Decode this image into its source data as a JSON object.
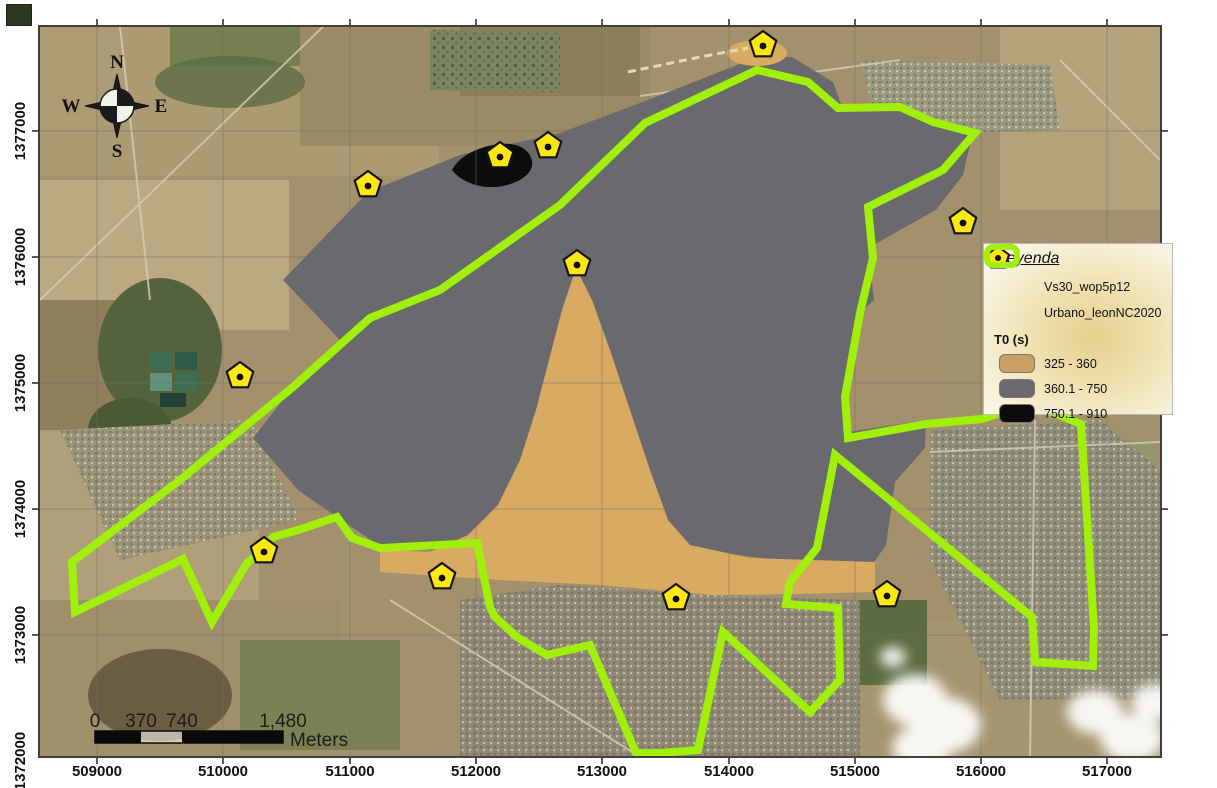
{
  "axes": {
    "x_ticks": [
      "509000",
      "510000",
      "511000",
      "512000",
      "513000",
      "514000",
      "515000",
      "516000",
      "517000"
    ],
    "y_ticks": [
      "1377000",
      "1376000",
      "1375000",
      "1374000",
      "1373000",
      "1372000"
    ]
  },
  "compass": {
    "n": "N",
    "s": "S",
    "e": "E",
    "w": "W"
  },
  "scalebar": {
    "labels": [
      "0",
      "370",
      "740",
      "1,480"
    ],
    "unit": "Meters"
  },
  "legend": {
    "title": "Leyenda",
    "items": [
      {
        "symbol": "pentagon-marker",
        "label": "Vs30_wop5p12"
      },
      {
        "symbol": "green-outline",
        "label": "Urbano_leonNC2020"
      }
    ],
    "section_title": "T0 (s)",
    "classes": [
      {
        "range": "325 - 360",
        "color": "#c9a263"
      },
      {
        "range": "360.1 - 750",
        "color": "#6a696d"
      },
      {
        "range": "750.1 - 910",
        "color": "#0c0c0c"
      }
    ]
  },
  "layers": {
    "markers": {
      "name": "Vs30_wop5p12",
      "fill": "#ffe70f",
      "points": [
        [
          763,
          45
        ],
        [
          500,
          156
        ],
        [
          548,
          146
        ],
        [
          368,
          185
        ],
        [
          577,
          264
        ],
        [
          963,
          222
        ],
        [
          240,
          376
        ],
        [
          264,
          551
        ],
        [
          442,
          577
        ],
        [
          676,
          598
        ],
        [
          887,
          595
        ]
      ]
    },
    "urban_boundary": {
      "name": "Urbano_leonNC2020",
      "color": "#a2ef0a",
      "points": [
        [
          645,
          123
        ],
        [
          757,
          70
        ],
        [
          808,
          82
        ],
        [
          838,
          108
        ],
        [
          900,
          107
        ],
        [
          933,
          122
        ],
        [
          975,
          133
        ],
        [
          943,
          170
        ],
        [
          868,
          207
        ],
        [
          873,
          258
        ],
        [
          860,
          313
        ],
        [
          845,
          397
        ],
        [
          848,
          438
        ],
        [
          926,
          424
        ],
        [
          982,
          419
        ],
        [
          1030,
          403
        ],
        [
          1081,
          424
        ],
        [
          1094,
          628
        ],
        [
          1093,
          666
        ],
        [
          1035,
          662
        ],
        [
          1032,
          617
        ],
        [
          835,
          455
        ],
        [
          817,
          548
        ],
        [
          790,
          582
        ],
        [
          786,
          604
        ],
        [
          838,
          608
        ],
        [
          840,
          680
        ],
        [
          810,
          712
        ],
        [
          723,
          632
        ],
        [
          698,
          750
        ],
        [
          660,
          753
        ],
        [
          636,
          753
        ],
        [
          590,
          645
        ],
        [
          547,
          655
        ],
        [
          517,
          637
        ],
        [
          495,
          617
        ],
        [
          490,
          607
        ],
        [
          477,
          543
        ],
        [
          380,
          548
        ],
        [
          352,
          538
        ],
        [
          337,
          517
        ],
        [
          298,
          530
        ],
        [
          273,
          537
        ],
        [
          258,
          555
        ],
        [
          247,
          563
        ],
        [
          212,
          622
        ],
        [
          183,
          559
        ],
        [
          75,
          612
        ],
        [
          72,
          562
        ],
        [
          180,
          480
        ],
        [
          293,
          387
        ],
        [
          370,
          318
        ],
        [
          440,
          290
        ],
        [
          560,
          205
        ]
      ]
    },
    "t0_zones": {
      "gray": {
        "range": "360.1 - 750",
        "fill": "#6a696d",
        "points": [
          [
            368,
            192
          ],
          [
            460,
            155
          ],
          [
            560,
            133
          ],
          [
            648,
            100
          ],
          [
            755,
            58
          ],
          [
            792,
            57
          ],
          [
            833,
            82
          ],
          [
            843,
            110
          ],
          [
            900,
            106
          ],
          [
            938,
            122
          ],
          [
            972,
            136
          ],
          [
            963,
            175
          ],
          [
            936,
            210
          ],
          [
            868,
            248
          ],
          [
            874,
            300
          ],
          [
            860,
            313
          ],
          [
            845,
            397
          ],
          [
            848,
            432
          ],
          [
            926,
            420
          ],
          [
            925,
            448
          ],
          [
            895,
            482
          ],
          [
            886,
            545
          ],
          [
            872,
            565
          ],
          [
            800,
            563
          ],
          [
            700,
            550
          ],
          [
            600,
            545
          ],
          [
            500,
            543
          ],
          [
            430,
            550
          ],
          [
            380,
            546
          ],
          [
            337,
            517
          ],
          [
            298,
            490
          ],
          [
            253,
            438
          ],
          [
            293,
            387
          ],
          [
            340,
            340
          ],
          [
            283,
            280
          ]
        ]
      },
      "tan": {
        "range": "325 - 360",
        "fill": "#d9aa62",
        "points": [
          [
            576,
            268
          ],
          [
            562,
            310
          ],
          [
            549,
            360
          ],
          [
            536,
            410
          ],
          [
            520,
            460
          ],
          [
            498,
            505
          ],
          [
            468,
            535
          ],
          [
            430,
            552
          ],
          [
            380,
            550
          ],
          [
            380,
            572
          ],
          [
            500,
            580
          ],
          [
            600,
            585
          ],
          [
            713,
            595
          ],
          [
            800,
            594
          ],
          [
            875,
            592
          ],
          [
            875,
            562
          ],
          [
            750,
            558
          ],
          [
            690,
            545
          ],
          [
            668,
            520
          ],
          [
            650,
            470
          ],
          [
            630,
            410
          ],
          [
            610,
            350
          ],
          [
            592,
            300
          ]
        ]
      },
      "black": {
        "range": "750.1 - 910",
        "fill": "#0c0c0c",
        "path": "M452,170 C460,154 482,146 500,144 C518,142 530,150 532,161 C534,172 522,182 503,186 C483,190 462,183 452,170 Z"
      }
    }
  }
}
